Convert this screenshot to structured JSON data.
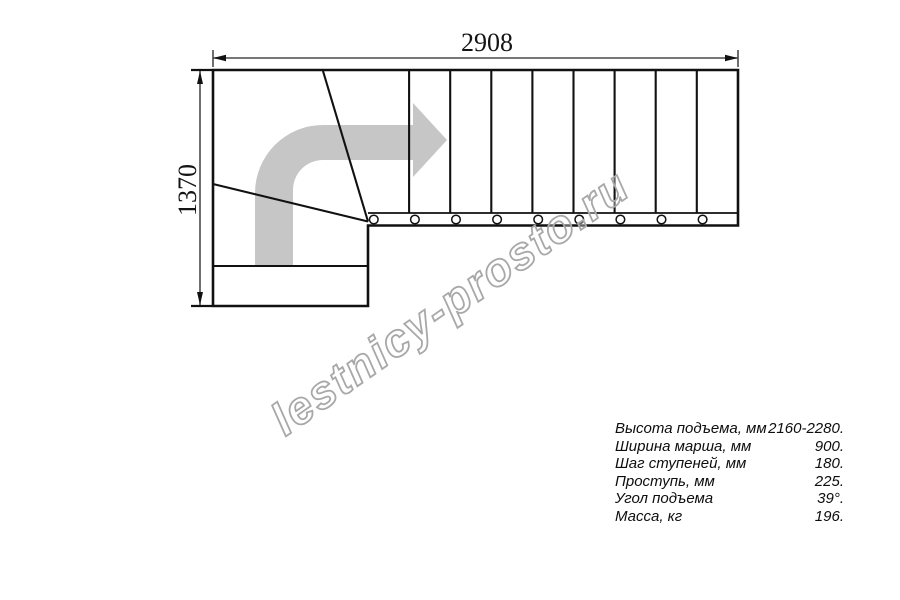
{
  "drawing": {
    "title_watermark": "lestnicy-prosto.ru",
    "dimensions": {
      "width_mm": "2908",
      "height_mm": "1370"
    },
    "straight_flight_tread_lines": 8,
    "baluster_count": 9,
    "colors": {
      "line": "#111111",
      "dimension_line": "#4a4a4a",
      "direction_arrow": "#c6c6c6",
      "watermark_outline": "#a8a8a8"
    }
  },
  "specs": {
    "rows": [
      {
        "label": "Высота подъема, мм",
        "value": "2160-2280."
      },
      {
        "label": "Ширина марша, мм",
        "value": "900."
      },
      {
        "label": "Шаг ступеней, мм",
        "value": "180."
      },
      {
        "label": "Проступь, мм",
        "value": "225."
      },
      {
        "label": "Угол подъема",
        "value": "39°."
      },
      {
        "label": "Масса, кг",
        "value": "196."
      }
    ]
  }
}
